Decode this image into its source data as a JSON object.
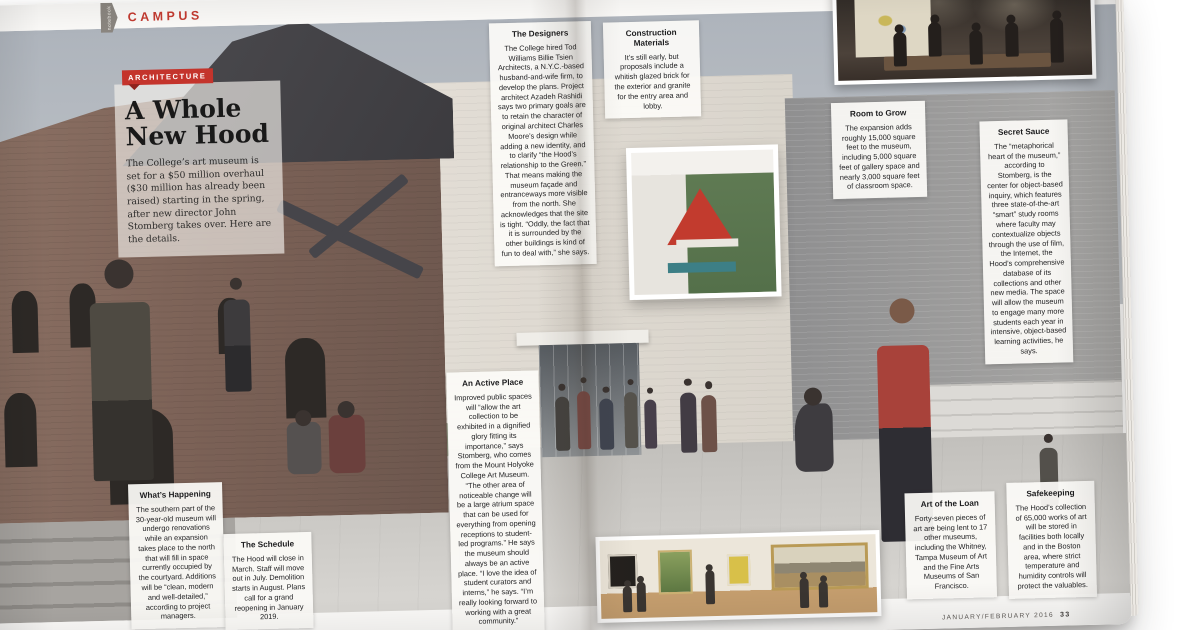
{
  "page": {
    "section_tab": "notebook",
    "section_label": "CAMPUS",
    "category_label": "ARCHITECTURE",
    "headline_line1": "A Whole",
    "headline_line2": "New Hood",
    "intro": "The College’s art museum is set for a $50 million overhaul ($30 million has already been raised) starting in the spring, after new director John Stomberg takes over. Here are the details.",
    "footer_left_num": "32",
    "footer_left_text": "DARTMOUTH ALUMNI MAGAZINE",
    "footer_right_text": "JANUARY/FEBRUARY 2016",
    "footer_right_num": "33",
    "accent_color": "#c4342c"
  },
  "callouts": [
    {
      "title": "The Designers",
      "body": "The College hired Tod Williams Billie Tsien Architects, a N.Y.C.-based husband-and-wife firm, to develop the plans. Project architect Azadeh Rashidi says two primary goals are to retain the character of original architect Charles Moore’s design while adding a new identity, and to clarify “the Hood’s relationship to the Green.” That means making the museum façade and entranceways more visible from the north. She acknowledges that the site is tight. “Oddly, the fact that it is surrounded by the other buildings is kind of fun to deal with,” she says."
    },
    {
      "title": "Construction Materials",
      "body": "It’s still early, but proposals include a whitish glazed brick for the exterior and granite for the entry area and lobby."
    },
    {
      "title": "Room to Grow",
      "body": "The expansion adds roughly 15,000 square feet to the museum, including 5,000 square feet of gallery space and nearly 3,000 square feet of classroom space."
    },
    {
      "title": "Secret Sauce",
      "body": "The “metaphorical heart of the museum,” according to Stomberg, is the center for object-based inquiry, which features three state-of-the-art “smart” study rooms where faculty may contextualize objects through the use of film, the Internet, the Hood’s comprehensive database of its collections and other new media. The space will allow the museum to engage many more students each year in intensive, object-based learning activities, he says."
    },
    {
      "title": "An Active Place",
      "body": "Improved public spaces will “allow the art collection to be exhibited in a dignified glory fitting its importance,” says Stomberg, who comes from the Mount Holyoke College Art Museum. “The other area of noticeable change will be a large atrium space that can be used for everything from opening receptions to student-led programs.” He says the museum should always be an active place. “I love the idea of student curators and interns,” he says. “I’m really looking forward to working with a great community.”"
    },
    {
      "title": "What’s Happening",
      "body": "The southern part of the 30-year-old museum will undergo renovations while an expansion takes place to the north that will fill in space currently occupied by the courtyard. Additions will be “clean, modern and well-detailed,” according to project managers."
    },
    {
      "title": "The Schedule",
      "body": "The Hood will close in March. Staff will move out in July. Demolition starts in August. Plans call for a grand reopening in January 2019."
    },
    {
      "title": "Art of the Loan",
      "body": "Forty-seven pieces of art are being lent to 17 other museums, including the Whitney, Tampa Museum of Art and the Fine Arts Museums of San Francisco."
    },
    {
      "title": "Safekeeping",
      "body": "The Hood’s collection of 65,000 works of art will be stored in facilities both locally and in the Boston area, where strict temperature and humidity controls will protect the valuables."
    }
  ]
}
